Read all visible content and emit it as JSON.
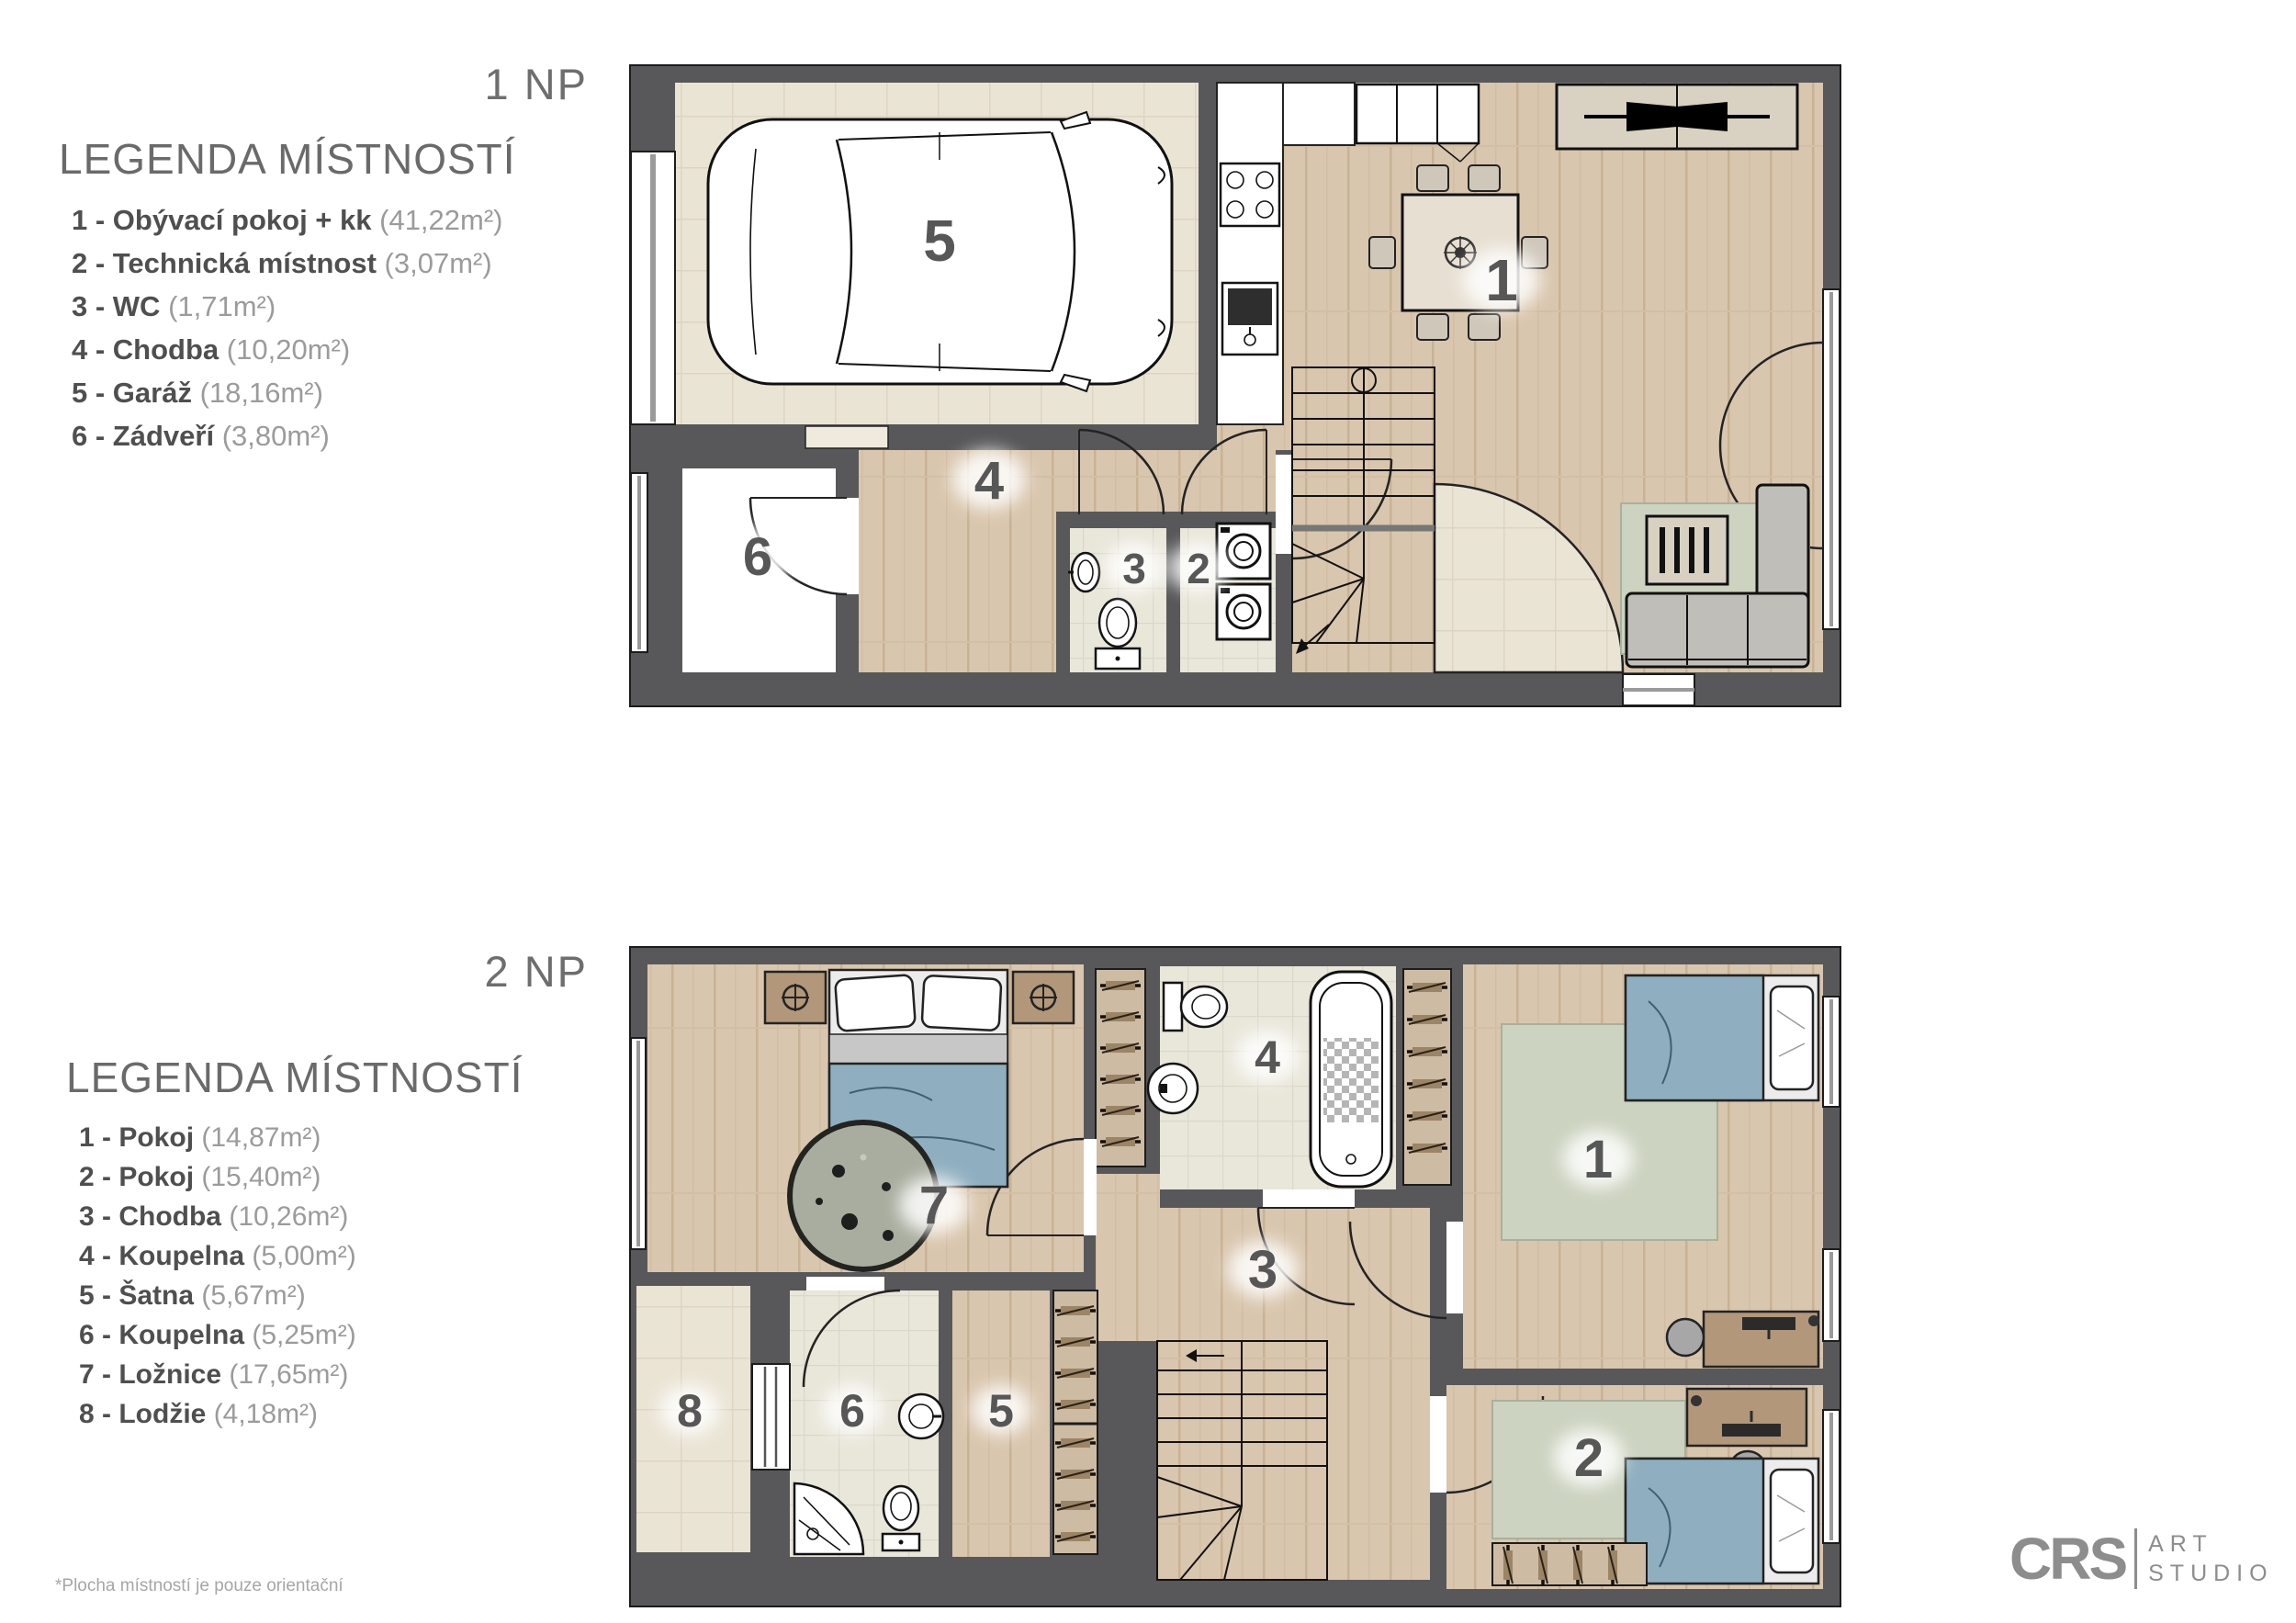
{
  "floor1": {
    "title": "1 NP",
    "legend_title": "LEGENDA MÍSTNOSTÍ",
    "items": [
      {
        "num": "1",
        "label": "1 - Obývací pokoj + kk",
        "area": "(41,22m²)"
      },
      {
        "num": "2",
        "label": "2 - Technická místnost",
        "area": "(3,07m²)"
      },
      {
        "num": "3",
        "label": "3 - WC",
        "area": "(1,71m²)"
      },
      {
        "num": "4",
        "label": "4 - Chodba",
        "area": "(10,20m²)"
      },
      {
        "num": "5",
        "label": "5 - Garáž",
        "area": "(18,16m²)"
      },
      {
        "num": "6",
        "label": "6 - Zádveří",
        "area": "(3,80m²)"
      }
    ]
  },
  "floor2": {
    "title": "2 NP",
    "legend_title": "LEGENDA MÍSTNOSTÍ",
    "items": [
      {
        "num": "1",
        "label": "1 - Pokoj",
        "area": "(14,87m²)"
      },
      {
        "num": "2",
        "label": "2 - Pokoj",
        "area": "(15,40m²)"
      },
      {
        "num": "3",
        "label": "3 - Chodba",
        "area": "(10,26m²)"
      },
      {
        "num": "4",
        "label": "4 - Koupelna",
        "area": "(5,00m²)"
      },
      {
        "num": "5",
        "label": "5 - Šatna",
        "area": "(5,67m²)"
      },
      {
        "num": "6",
        "label": "6 - Koupelna",
        "area": "(5,25m²)"
      },
      {
        "num": "7",
        "label": "7 - Ložnice",
        "area": "(17,65m²)"
      },
      {
        "num": "8",
        "label": "8 - Lodžie",
        "area": "(4,18m²)"
      }
    ]
  },
  "footnote": "*Plocha místností je pouze orientační",
  "logo": {
    "mark": "CRS",
    "line1": "ART",
    "line2": "STUDIO"
  },
  "colors": {
    "wall": "#58585a",
    "wood_floor": "#d9c6ae",
    "tile_floor": "#eae4d5",
    "bath_tile": "#e9e6da",
    "rug_sage": "#ccd3c0",
    "duvet_blue": "#8fafc0",
    "label_gray": "#575757"
  }
}
